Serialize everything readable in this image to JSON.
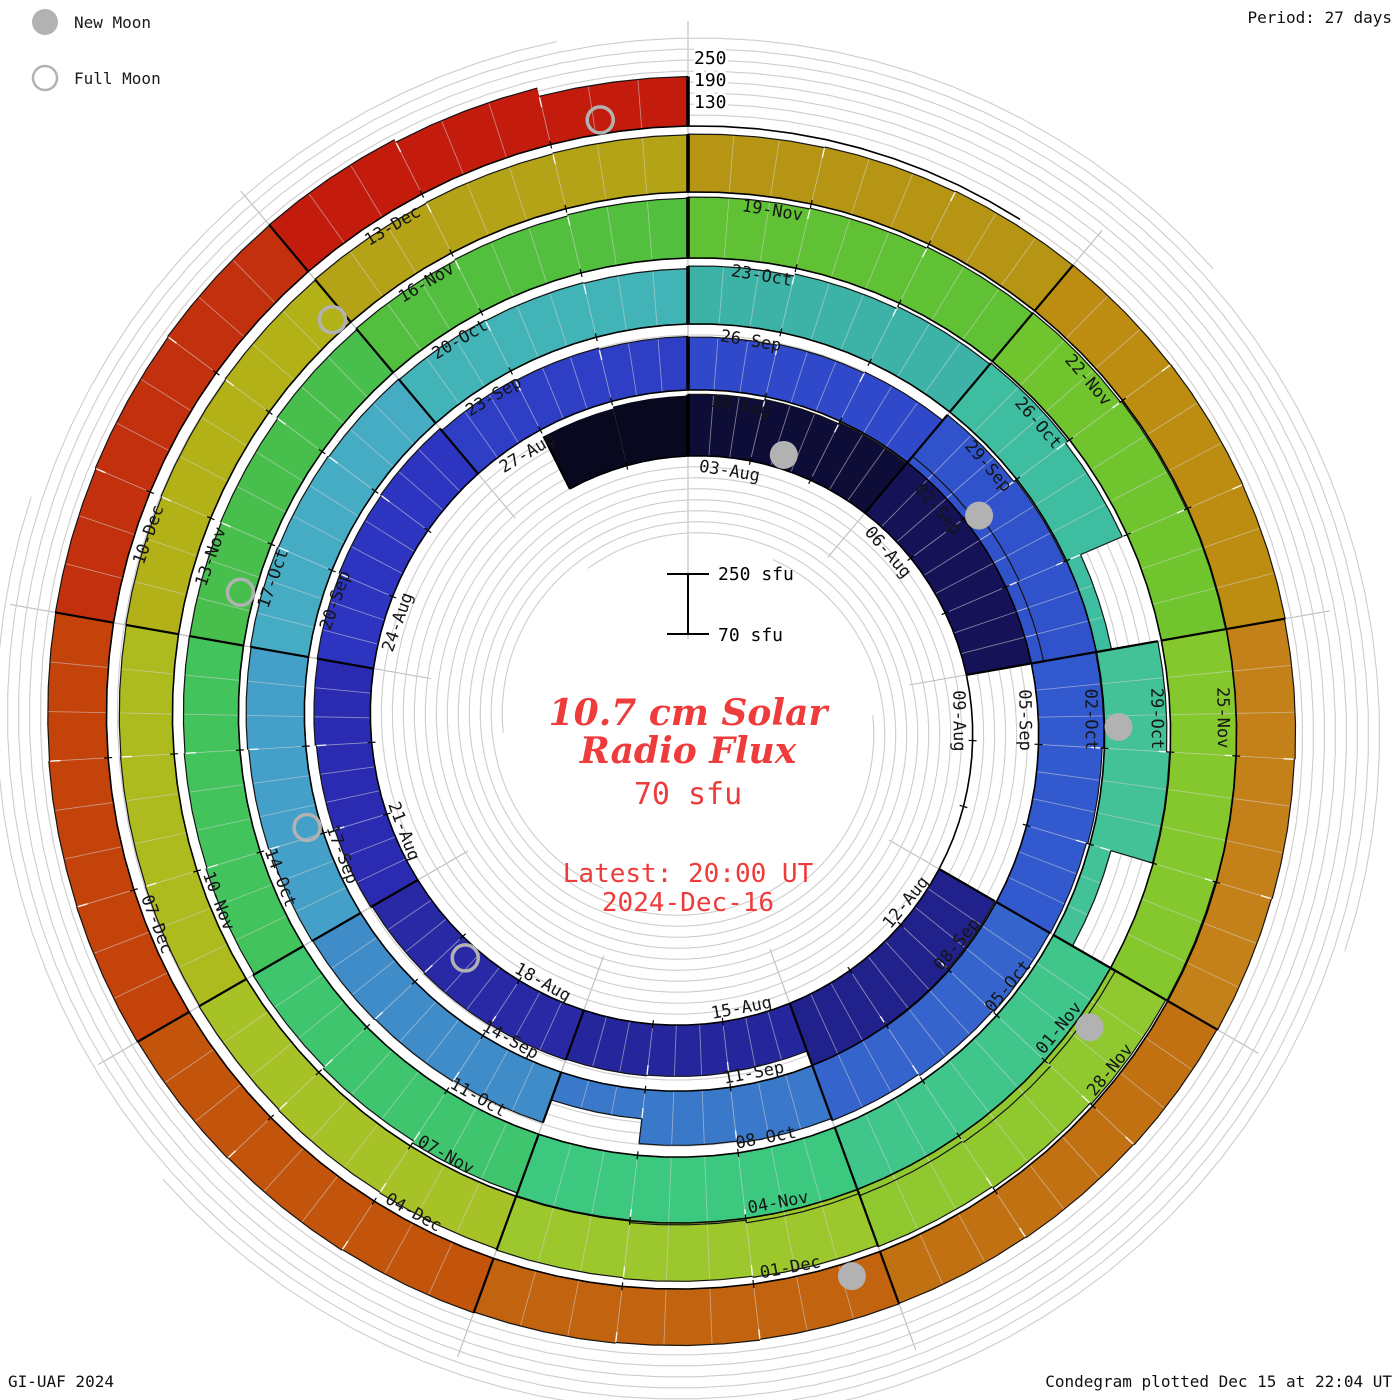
{
  "legend": {
    "new_moon_label": "New Moon",
    "full_moon_label": "Full Moon"
  },
  "period_label": "Period: 27 days",
  "footer": {
    "left": "GI-UAF 2024",
    "right": "Condegram plotted Dec 15 at 22:04 UT"
  },
  "center": {
    "title_line1": "10.7 cm Solar",
    "title_line2": "Radio Flux",
    "current_value": "70 sfu",
    "latest_line1": "Latest: 20:00 UT",
    "latest_line2": "2024-Dec-16"
  },
  "scale_bar": {
    "top_label": "250 sfu",
    "bottom_label": "70 sfu"
  },
  "radial_scale_labels": [
    "250",
    "190",
    "130"
  ],
  "colors": {
    "accent": "#ee3b3b",
    "grid": "#c6c6c6",
    "spoke": "#bdbdbd",
    "moon": "#b2b2b2",
    "ink": "#111111"
  },
  "chart_data": {
    "type": "bar",
    "layout": "polar-spiral-condegram",
    "title": "10.7 cm Solar Radio Flux",
    "units": "sfu",
    "period_days": 27,
    "turns": 5,
    "flux_base": 70,
    "flux_top": 250,
    "gridline_step_sfu": 30,
    "labeled_levels_sfu": [
      130,
      190,
      250
    ],
    "start_date": "2024-08-03",
    "end_date": "2024-12-16",
    "segment_days": 3,
    "segment_labels": [
      "03-Aug",
      "06-Aug",
      "09-Aug",
      "12-Aug",
      "15-Aug",
      "18-Aug",
      "21-Aug",
      "24-Aug",
      "27-Aug",
      "30-Aug",
      "02-Sep",
      "05-Sep",
      "08-Sep",
      "11-Sep",
      "14-Sep",
      "17-Sep",
      "20-Sep",
      "23-Sep",
      "26-Sep",
      "29-Sep",
      "02-Oct",
      "05-Oct",
      "08-Oct",
      "11-Oct",
      "14-Oct",
      "17-Oct",
      "20-Oct",
      "23-Oct",
      "26-Oct",
      "29-Oct",
      "01-Nov",
      "04-Nov",
      "07-Nov",
      "10-Nov",
      "13-Nov",
      "16-Nov",
      "19-Nov",
      "22-Nov",
      "25-Nov",
      "28-Nov",
      "01-Dec",
      "04-Dec",
      "07-Dec",
      "10-Dec",
      "13-Dec"
    ],
    "segment_colors": [
      "#0d0d38",
      "#151257",
      "#1b1b70",
      "#21218c",
      "#26269c",
      "#2929a6",
      "#2b2bb2",
      "#2d35c0",
      "#2e3fc6",
      "#2f49ca",
      "#3053cc",
      "#3259ce",
      "#3464cc",
      "#3a78ca",
      "#3f8cc9",
      "#44a0c8",
      "#46acc4",
      "#42b4b8",
      "#3db3a8",
      "#3fbda0",
      "#42c296",
      "#40c68a",
      "#3cc87e",
      "#3ec56e",
      "#42c35c",
      "#48bf4c",
      "#52c03e",
      "#5fc133",
      "#70c42e",
      "#84c82e",
      "#90c830",
      "#9cc82e",
      "#a6c226",
      "#adbb1f",
      "#b2b118",
      "#b4a317",
      "#b69514",
      "#bd8d12",
      "#c48119",
      "#c27112",
      "#c2630f",
      "#c2540c",
      "#c4430b",
      "#c3300e",
      "#c31b0c"
    ],
    "daily_flux": [
      238,
      242,
      246,
      272,
      290,
      284,
      72,
      72,
      72,
      246,
      252,
      250,
      208,
      210,
      212,
      214,
      216,
      214,
      218,
      221,
      224,
      226,
      229,
      231,
      224,
      220,
      216,
      214,
      217,
      220,
      240,
      246,
      250,
      248,
      244,
      240,
      238,
      234,
      230,
      224,
      218,
      150,
      216,
      219,
      221,
      223,
      226,
      229,
      231,
      229,
      227,
      225,
      223,
      221,
      228,
      234,
      240,
      244,
      236,
      112,
      240,
      248,
      130,
      265,
      272,
      268,
      262,
      255,
      248,
      240,
      234,
      229,
      225,
      222,
      220,
      219,
      221,
      224,
      227,
      230,
      233,
      236,
      238,
      241,
      243,
      246,
      248,
      250,
      249,
      247,
      244,
      240,
      236,
      232,
      229,
      226,
      223,
      221,
      219,
      217,
      216,
      215,
      216,
      218,
      220,
      222,
      224,
      226,
      228,
      230,
      232,
      233,
      234,
      233,
      231,
      229,
      227,
      225,
      223,
      221,
      222,
      224,
      226,
      228,
      230,
      232,
      233,
      232,
      230,
      231,
      233,
      235,
      236,
      228,
      205
    ],
    "pre_start": {
      "date": "2024-08-01",
      "flux": [
        230,
        235
      ],
      "color": "#08081f"
    },
    "moons": {
      "new": [
        {
          "label": "2024-08-04",
          "day": 1.47
        },
        {
          "label": "2024-09-03",
          "day": 31.08
        },
        {
          "label": "2024-10-02",
          "day": 60.78
        },
        {
          "label": "2024-11-01",
          "day": 90.53
        },
        {
          "label": "2024-12-01",
          "day": 120.26
        }
      ],
      "full": [
        {
          "label": "2024-08-19",
          "day": 16.77
        },
        {
          "label": "2024-09-18",
          "day": 46.11
        },
        {
          "label": "2024-10-17",
          "day": 75.48
        },
        {
          "label": "2024-11-15",
          "day": 104.9
        },
        {
          "label": "2024-12-15",
          "day": 134.38
        }
      ]
    }
  }
}
